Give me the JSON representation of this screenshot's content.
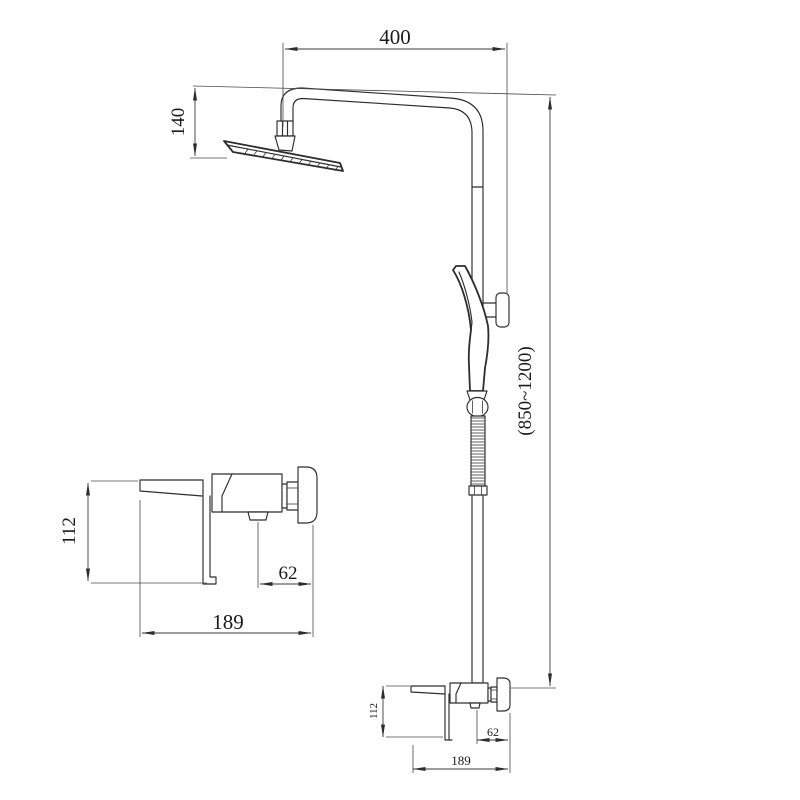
{
  "drawing": {
    "background_color": "#ffffff",
    "line_color": "#2d2d2d",
    "text_color": "#1b1b1b",
    "main_view": {
      "arm_reach_mm": "400",
      "head_drop_mm": "140",
      "column_height_mm": "(850~1200)",
      "mixer_height_mm": "112",
      "mixer_outlet_to_flange_mm": "62",
      "mixer_length_mm": "189"
    },
    "mixer_detail_view": {
      "height_mm": "112",
      "outlet_to_flange_mm": "62",
      "length_mm": "189"
    }
  }
}
